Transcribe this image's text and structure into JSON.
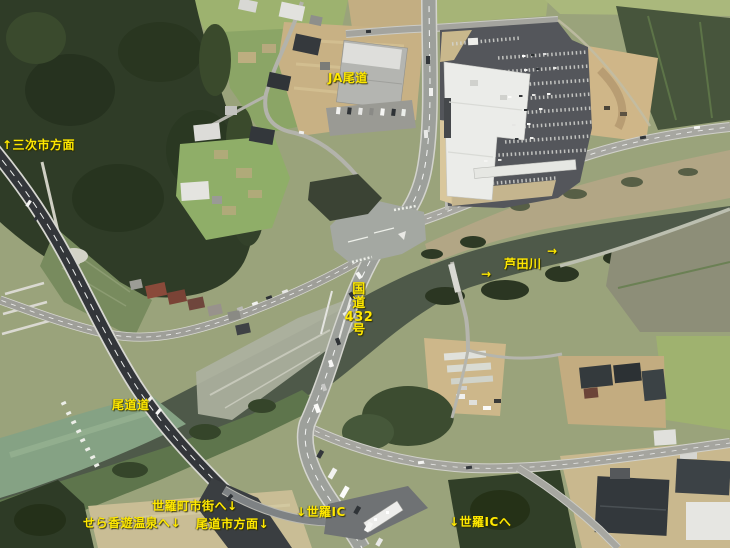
{
  "annotations": {
    "ja_onomichi": {
      "text": "JA尾道"
    },
    "miyoshi_direction": {
      "text": "↑三次市方面"
    },
    "ashida_arrow_upper": {
      "text": "→"
    },
    "ashida_river": {
      "text": "芦田川"
    },
    "ashida_arrow_lower": {
      "text": "→"
    },
    "route_432": {
      "text": "国\n道\n432\n号"
    },
    "onomichi_expressway": {
      "text": "尾道道"
    },
    "sera_town_center": {
      "text": "世羅町市街へ↓"
    },
    "sera_koyu_onsen": {
      "text": "せら香遊温泉へ↓"
    },
    "onomichi_city_direction": {
      "text": "尾道市方面↓"
    },
    "sera_ic": {
      "text": "↓世羅IC"
    },
    "sera_ic_east": {
      "text": "↓世羅ICへ"
    }
  },
  "colors": {
    "annotation_yellow": "#ffe800",
    "forest_green": "#2f3c27",
    "field_green": "#8fac67",
    "dirt_tan": "#c8b184",
    "river_dark": "#4e5949",
    "river_muddy": "#85a284",
    "road_gray": "#a4a49e",
    "expressway_dark": "#33363a",
    "parking_asphalt": "#54565b",
    "building_white": "#ebece9"
  }
}
